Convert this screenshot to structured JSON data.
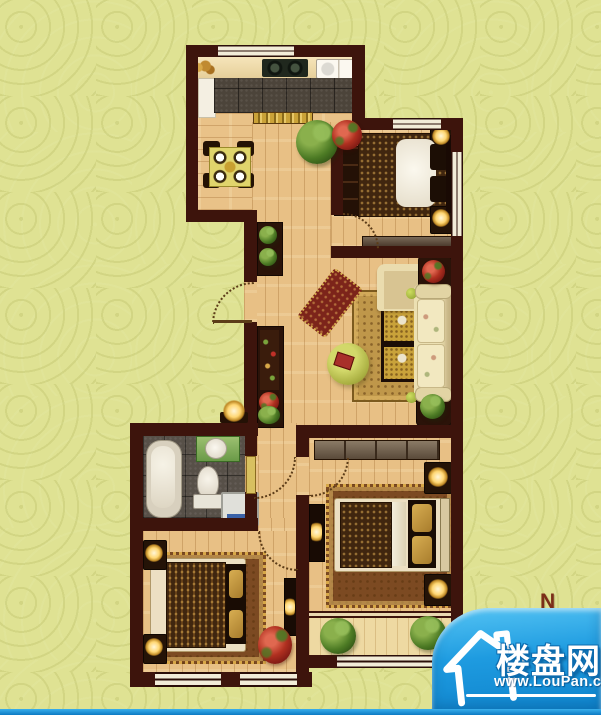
{
  "canvas": {
    "width": 601,
    "height": 715,
    "background_color": "#dfe293"
  },
  "compass": {
    "label": "N",
    "color": "#7b2e18"
  },
  "logo": {
    "site_name": "楼盘网",
    "site_url": "www.LouPan.com",
    "bubble_color": "#1e9be0",
    "text_color": "#ffffff",
    "icon": "house-icon"
  },
  "floorplan": {
    "type": "residential-floor-plan",
    "wall_color": "#3d140c",
    "floor_wood_color": "#e8c085",
    "kitchen_tile_color": "#4c443a",
    "bathroom_tile_color": "#575048",
    "rug_color": "#bf974a",
    "rooms": [
      {
        "name": "kitchen",
        "furniture": [
          "counter",
          "gas-stove",
          "sink",
          "fridge-column",
          "window"
        ]
      },
      {
        "name": "dining-area",
        "furniture": [
          "dining-table",
          "chair",
          "chair",
          "chair",
          "chair",
          "threshold-strip"
        ]
      },
      {
        "name": "entry-hall",
        "furniture": [
          "entry-door",
          "plant-shelf",
          "display-cabinet",
          "table-lamp"
        ]
      },
      {
        "name": "living-room",
        "furniture": [
          "sofa",
          "armchair",
          "coffee-table",
          "coffee-table",
          "round-ottoman",
          "chaise-lounge",
          "area-rug",
          "potted-plant",
          "red-flowers"
        ]
      },
      {
        "name": "bedroom-north",
        "furniture": [
          "double-bed",
          "wardrobe",
          "nightstand-lamp",
          "nightstand-lamp",
          "dresser",
          "window",
          "door"
        ]
      },
      {
        "name": "bathroom",
        "furniture": [
          "bathtub",
          "toilet",
          "wash-basin",
          "washing-machine",
          "door"
        ]
      },
      {
        "name": "bedroom-southwest",
        "furniture": [
          "double-bed",
          "nightstand-lamp",
          "nightstand-lamp",
          "tv-stand",
          "area-rug",
          "red-flowers",
          "window",
          "window",
          "door"
        ]
      },
      {
        "name": "bedroom-southeast",
        "furniture": [
          "double-bed",
          "nightstand-lamp",
          "nightstand-lamp",
          "wardrobe",
          "tv-stand",
          "area-rug",
          "door"
        ]
      },
      {
        "name": "balcony",
        "furniture": [
          "potted-plant",
          "potted-plant",
          "window"
        ]
      }
    ]
  }
}
